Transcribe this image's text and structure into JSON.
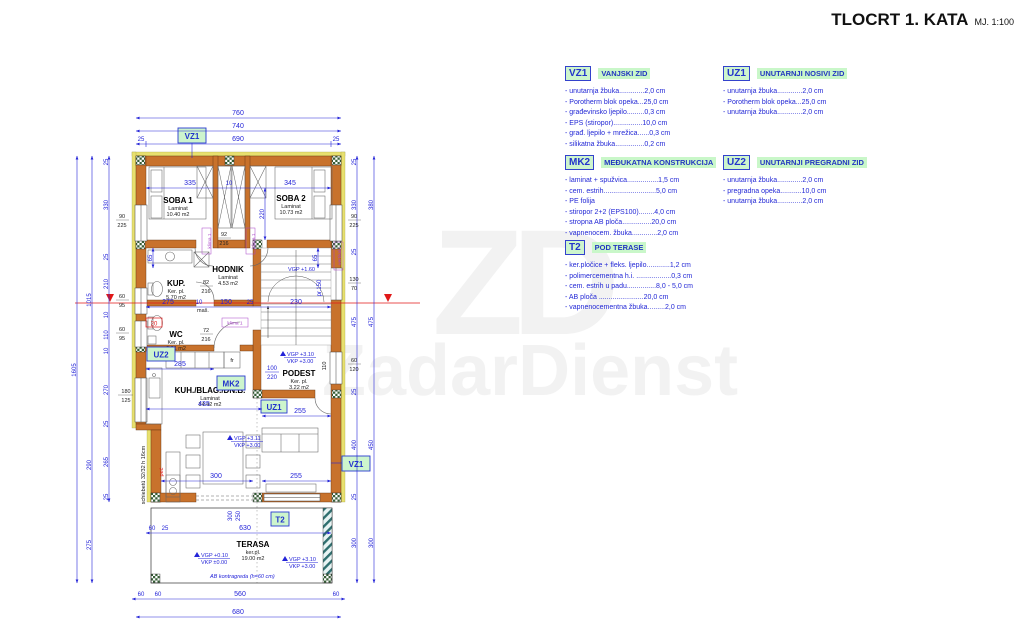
{
  "title": {
    "text": "TLOCRT 1. KATA",
    "scale": "MJ. 1:100"
  },
  "watermark": {
    "monogram": "ZD",
    "name": "ZadarDienst"
  },
  "legend": {
    "blocks": [
      {
        "code": "VZ1",
        "name": "VANJSKI ZID",
        "items": [
          "- unutarnja žbuka.............2,0 cm",
          "- Porotherm blok opeka...25,0 cm",
          "- građevinsko ljepilo.........0,3 cm",
          "- EPS (stiropor)...............10,0 cm",
          "- građ. ljepilo + mrežica......0,3 cm",
          "- silikatna žbuka...............0,2 cm"
        ]
      },
      {
        "code": "UZ1",
        "name": "UNUTARNJI NOSIVI ZID",
        "items": [
          "- unutarnja žbuka.............2,0 cm",
          "- Porotherm blok opeka...25,0 cm",
          "- unutarnja žbuka.............2,0 cm"
        ]
      },
      {
        "code": "MK2",
        "name": "MEĐUKATNA KONSTRUKCIJA",
        "items": [
          "- laminat + spužvica................1,5 cm",
          "- cem. estrih...........................5,0 cm",
          "- PE folija",
          "- stiropor 2+2 (EPS100)........4,0 cm",
          "- stropna AB ploča...............20,0 cm",
          "- vapnenocem. žbuka.............2,0 cm"
        ]
      },
      {
        "code": "UZ2",
        "name": "UNUTARNJI PREGRADNI ZID",
        "items": [
          "- unutarnja žbuka.............2,0 cm",
          "- pregradna opeka...........10,0 cm",
          "- unutarnja žbuka.............2,0 cm"
        ]
      },
      {
        "code": "T2",
        "name": "POD TERASE",
        "items": [
          "- ker.pločice + fleks. ljepilo............1,2 cm",
          "- polimercementna h.i. ..................0,3 cm",
          "- cem. estrih u padu...............8,0 - 5,0 cm",
          "- AB ploča .......................20,0 cm",
          "- vapnenocementna žbuka.........2,0 cm"
        ]
      }
    ]
  },
  "plan": {
    "markers": {
      "vz1": "VZ1",
      "uz1": "UZ1",
      "uz2": "UZ2",
      "mk2": "MK2",
      "t2": "T2"
    },
    "rooms": {
      "soba1": {
        "name": "SOBA 1",
        "finish": "Laminat",
        "area": "10.40 m2"
      },
      "soba2": {
        "name": "SOBA 2",
        "finish": "Laminat",
        "area": "10.73 m2"
      },
      "hodnik": {
        "name": "HODNIK",
        "finish": "Laminat",
        "area": "4.53 m2"
      },
      "kup": {
        "name": "KUP.",
        "finish": "Ker. pl.",
        "area": "5.70 m2"
      },
      "wc": {
        "name": "WC",
        "finish": "Ker. pl.",
        "area": "3.01 m2"
      },
      "podest": {
        "name": "PODEST",
        "finish": "Ker. pl.",
        "area": "3.22 m2"
      },
      "kuhinja": {
        "name": "KUH./BLAG./DN.B.",
        "finish": "Laminat",
        "area": "34.42 m2"
      },
      "terasa": {
        "name": "TERASA",
        "finish": "ker.pl.",
        "area": "19.00 m2"
      }
    },
    "levels": {
      "vgp160": "VGP +1.60",
      "vgp310": "VGP +3.10",
      "vkp300": "VKP +3.00",
      "vgp311": "VGP +3.11",
      "vgp010": "VGP +0.10",
      "vkp000": "VKP ±0.00"
    },
    "notes": {
      "ab": "AB kontragreda (h=60 cm)",
      "schiebe": "schiebetü 32/32 h 16cm",
      "klima": "klima 1",
      "vertikala": "vertikala",
      "pec": "peć",
      "s20": "20",
      "fr": "fr",
      "mas": "maš.",
      "pr150": "pr.150"
    },
    "dims": {
      "top": [
        "760",
        "740",
        "25",
        "690",
        "25"
      ],
      "bedrooms": [
        "335",
        "10",
        "345",
        "220",
        "65",
        "65"
      ],
      "middle": [
        "275",
        "10",
        "150",
        "25",
        "230"
      ],
      "lower": [
        "285",
        "435",
        "255",
        "300",
        "255"
      ],
      "podest": [
        "100",
        "220"
      ],
      "leftchain": [
        "25",
        "330",
        "25",
        "210",
        "10",
        "110",
        "10",
        "270",
        "25",
        "265",
        "25"
      ],
      "leftouter": [
        "1015",
        "290",
        "275"
      ],
      "lefttotal": "1605",
      "rightchain": [
        "25",
        "330",
        "25",
        "475",
        "25",
        "400",
        "25",
        "300"
      ],
      "rightouter": [
        "380",
        "475",
        "450",
        "300"
      ],
      "bottom1": [
        "60",
        "25",
        "630"
      ],
      "bottom2": [
        "60",
        "60",
        "560",
        "60"
      ],
      "bottom3": "680",
      "terracedoor": [
        "300",
        "250"
      ],
      "winleft": [
        [
          "90",
          "225"
        ],
        [
          "60",
          "95"
        ],
        [
          "60",
          "95"
        ],
        [
          "180",
          "125"
        ]
      ],
      "winright": [
        [
          "90",
          "225"
        ],
        [
          "130",
          "70"
        ],
        [
          "60",
          "120"
        ]
      ],
      "w110": "110",
      "doors": [
        [
          "92",
          "216"
        ],
        [
          "82",
          "216"
        ],
        [
          "72",
          "216"
        ]
      ]
    }
  },
  "colors": {
    "wall": "#c8722c",
    "insulation": "#e8e06e",
    "dim": "#2424d8",
    "accent_red": "#e01818",
    "accent_purple": "#a844c8",
    "label_bg": "#cdf5cd",
    "legend_text": "#2233cc"
  }
}
